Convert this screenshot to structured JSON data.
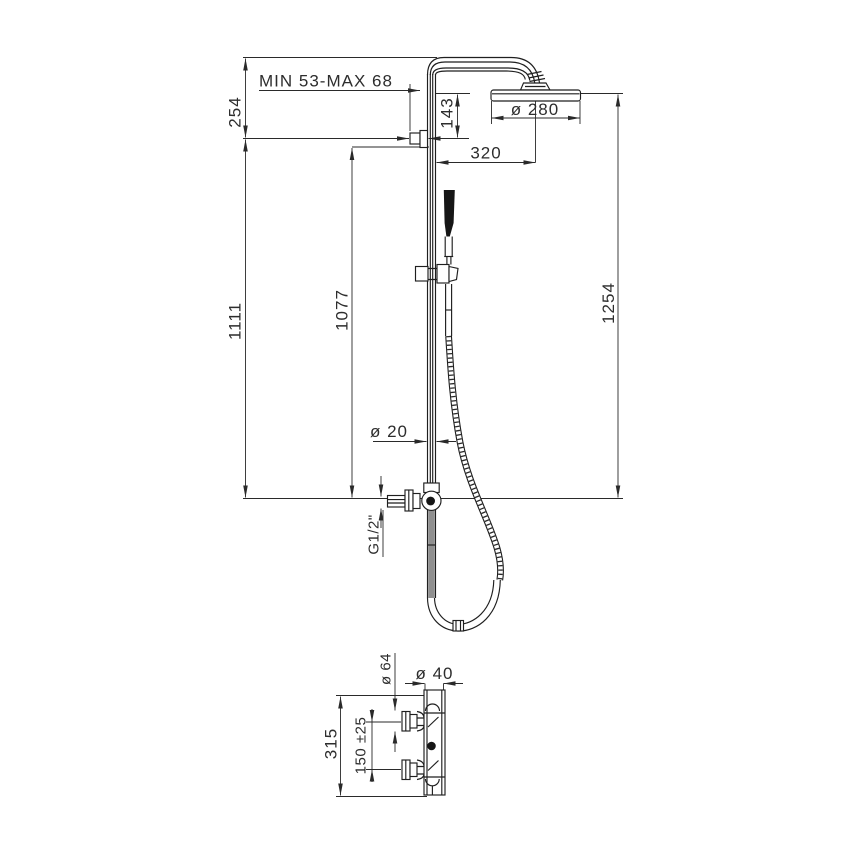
{
  "drawing": {
    "background": "#ffffff",
    "line_color": "#1f1f1f",
    "dim_color": "#2a2a2a",
    "labels": {
      "bracket_range": "MIN 53-MAX 68",
      "top_offset": "254",
      "head_drop": "143",
      "head_diameter": "ø 280",
      "arm_reach": "320",
      "column_height": "1111",
      "hose_height": "1077",
      "overall_height": "1254",
      "pipe_diameter": "ø 20",
      "thread": "G1/2\"",
      "union_diameter": "ø 64",
      "outlet_diameter": "ø 40",
      "body_height": "315",
      "inlet_spacing": "150 ±25"
    }
  }
}
